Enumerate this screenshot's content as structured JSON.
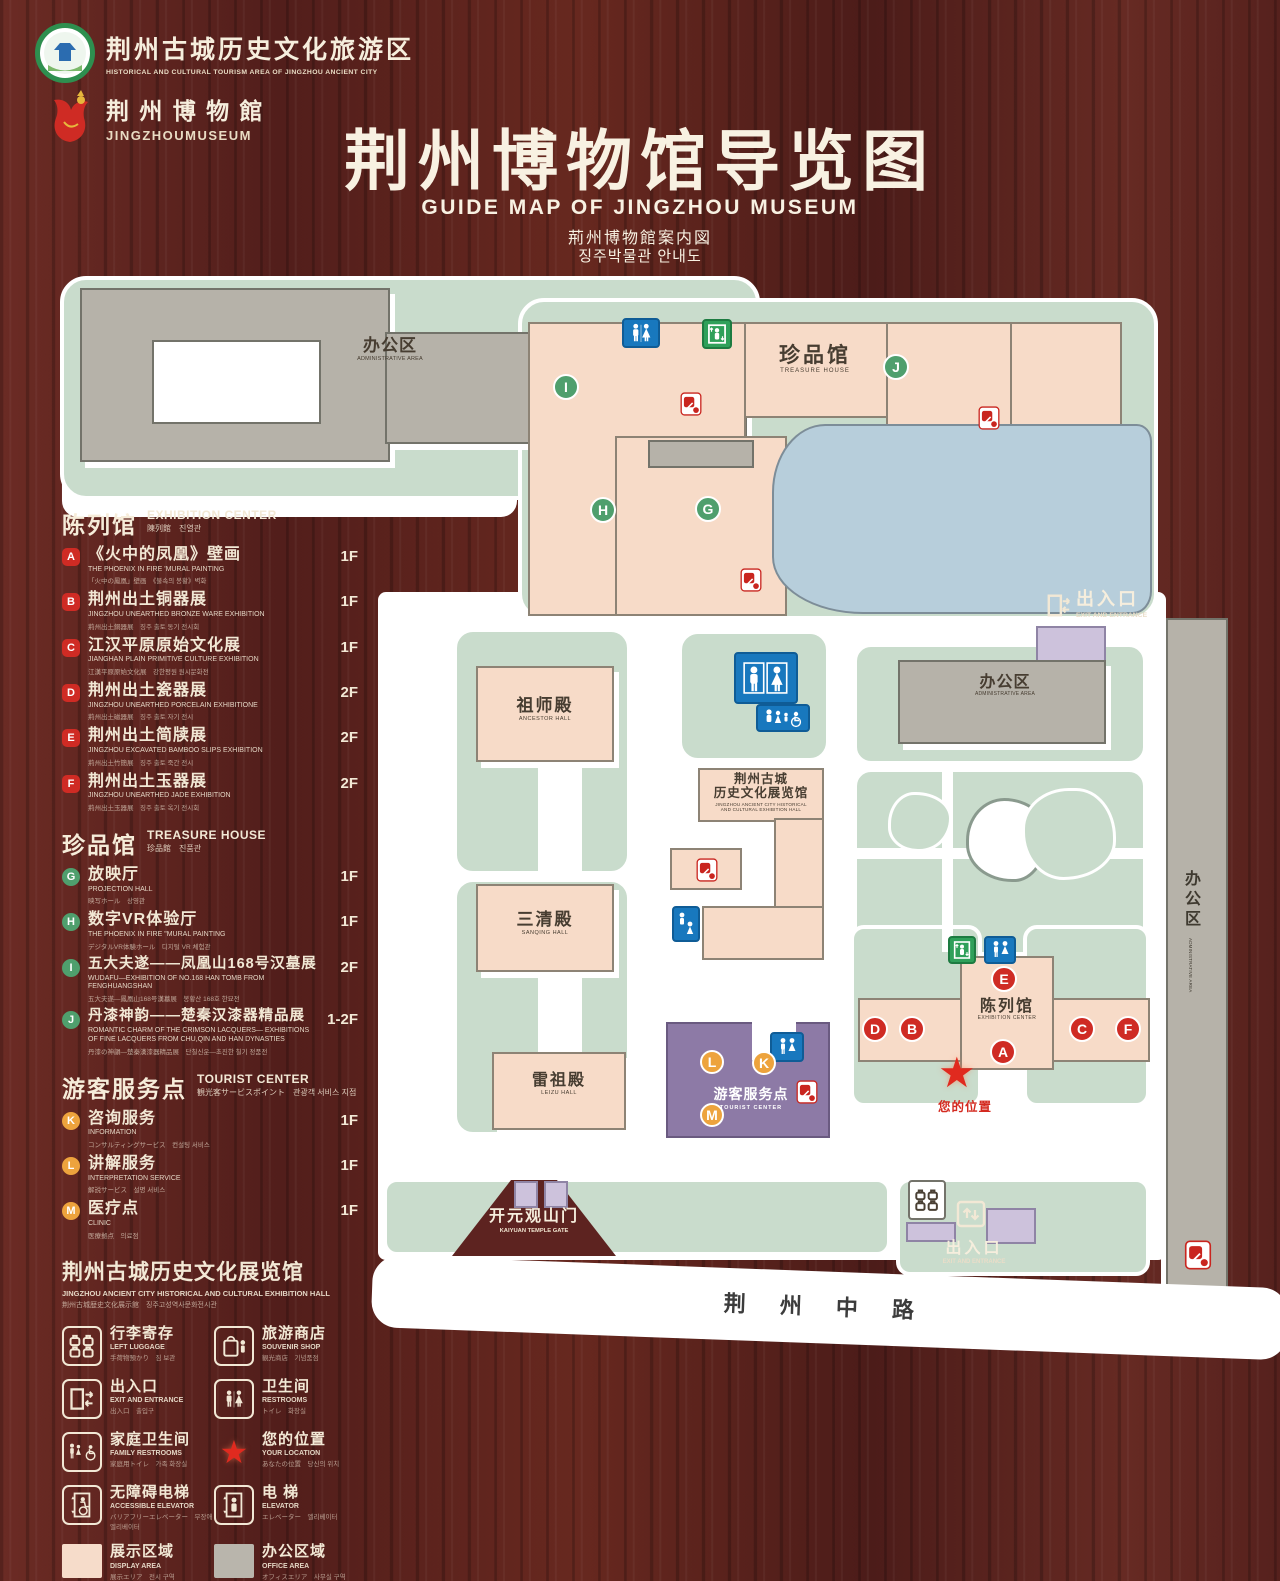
{
  "header": {
    "tourism_area": {
      "name_cn": "荆州古城历史文化旅游区",
      "name_en": "HISTORICAL AND CULTURAL TOURISM AREA OF JINGZHOU ANCIENT CITY"
    },
    "museum": {
      "name_cn": "荆 州 博 物 館",
      "name_en": "JINGZHOUMUSEUM"
    },
    "title": {
      "cn": "荆州博物馆导览图",
      "en": "GUIDE MAP OF JINGZHOU MUSEUM",
      "ja": "荊州博物館案内図",
      "ko": "징주박물관 안내도"
    }
  },
  "legend": {
    "sections": [
      {
        "title_cn": "陈列馆",
        "title_en": "EXHIBITION CENTER",
        "title_sub": "陳列館　진열관",
        "items": [
          {
            "letter": "A",
            "cn": "《火中的凤凰》壁画",
            "en": "THE PHOENIX IN FIRE 'MURAL PAINTING",
            "sub": "「火中の鳳凰」壁画　《불속의 봉황》벽화",
            "floor": "1F"
          },
          {
            "letter": "B",
            "cn": "荆州出土铜器展",
            "en": "JINGZHOU UNEARTHED BRONZE WARE EXHIBITION",
            "sub": "荊州出土銅器展　징주 출토 동기 전시회",
            "floor": "1F"
          },
          {
            "letter": "C",
            "cn": "江汉平原原始文化展",
            "en": "JIANGHAN PLAIN PRIMITIVE CULTURE EXHIBITION",
            "sub": "江漢平原原始文化展　강한평원 원시문화전",
            "floor": "1F"
          },
          {
            "letter": "D",
            "cn": "荆州出土瓷器展",
            "en": "JINGZHOU UNEARTHED PORCELAIN EXHIBITIONE",
            "sub": "荊州出土磁器展　징주 출토 자기 전시",
            "floor": "2F"
          },
          {
            "letter": "E",
            "cn": "荆州出土简牍展",
            "en": "JINGZHOU EXCAVATED BAMBOO SLIPS EXHIBITION",
            "sub": "荊州出土竹簡展　징주 출토 죽간 전시",
            "floor": "2F"
          },
          {
            "letter": "F",
            "cn": "荆州出土玉器展",
            "en": "JINGZHOU UNEARTHED JADE EXHIBITION",
            "sub": "荊州出土玉器展　징주 출토 옥기 전시회",
            "floor": "2F"
          }
        ]
      },
      {
        "title_cn": "珍品馆",
        "title_en": "TREASURE HOUSE",
        "title_sub": "珍品館　진품관",
        "items": [
          {
            "letter": "G",
            "cn": "放映厅",
            "en": "PROJECTION HALL",
            "sub": "映写ホール　상영관",
            "floor": "1F"
          },
          {
            "letter": "H",
            "cn": "数字VR体验厅",
            "en": "THE PHOENIX IN FIRE \"MURAL PAINTING",
            "sub": "デジタルVR体験ホール　디지털 VR 체험관",
            "floor": "1F"
          },
          {
            "letter": "I",
            "cn": "五大夫遂——凤凰山168号汉墓展",
            "en": "WUDAFU—EXHIBITION OF NO.168 HAN TOMB FROM FENGHUANGSHAN",
            "sub": "五大夫遂—鳳凰山168号漢墓展　봉황산 168호 한묘전",
            "floor": "2F"
          },
          {
            "letter": "J",
            "cn": "丹漆神韵——楚秦汉漆器精品展",
            "en": "ROMANTIC CHARM OF THE CRIMSON LACQUERS— EXHIBITIONS OF FINE LACQUERS FROM CHU,QIN AND HAN DYNASTIES",
            "sub": "丹漆の神韻—楚秦漢漆器精品展　단칠신운—초진한 칠기 정품전",
            "floor": "1-2F"
          }
        ]
      },
      {
        "title_cn": "游客服务点",
        "title_en": "TOURIST CENTER",
        "title_sub": "観光客サービスポイント　관광객 서비스 지점",
        "items": [
          {
            "letter": "K",
            "cn": "咨询服务",
            "en": "INFORMATION",
            "sub": "コンサルティングサービス　컨설팅 서비스",
            "floor": "1F"
          },
          {
            "letter": "L",
            "cn": "讲解服务",
            "en": "INTERPRETATION SERVICE",
            "sub": "解説サービス　설명 서비스",
            "floor": "1F"
          },
          {
            "letter": "M",
            "cn": "医疗点",
            "en": "CLINIC",
            "sub": "医療拠点　의료점",
            "floor": "1F"
          }
        ]
      }
    ],
    "hall_note": {
      "cn": "荆州古城历史文化展览馆",
      "en": "JINGZHOU ANCIENT CITY HISTORICAL AND CULTURAL EXHIBITION HALL",
      "sub": "荆州古城歴史文化展示館　징주고성역사문화전시관"
    },
    "symbols": [
      {
        "cn": "行李寄存",
        "en": "LEFT LUGGAGE",
        "sub": "手荷物預かり　짐 보관"
      },
      {
        "cn": "旅游商店",
        "en": "SOUVENIR SHOP",
        "sub": "観光商店　기념품점"
      },
      {
        "cn": "出入口",
        "en": "EXIT AND ENTRANCE",
        "sub": "出入口　출입구"
      },
      {
        "cn": "卫生间",
        "en": "RESTROOMS",
        "sub": "トイレ　화장실"
      },
      {
        "cn": "家庭卫生间",
        "en": "FAMILY RESTROOMS",
        "sub": "家庭用トイレ　가족 화장실"
      },
      {
        "cn": "您的位置",
        "en": "YOUR LOCATION",
        "sub": "あなたの位置　당신의 위치"
      },
      {
        "cn": "无障碍电梯",
        "en": "ACCESSIBLE ELEVATOR",
        "sub": "バリアフリーエレベーター　무장애 엘리베이터"
      },
      {
        "cn": "电 梯",
        "en": "ELEVATOR",
        "sub": "エレベーター　엘리베이터"
      }
    ],
    "areas": [
      {
        "cn": "展示区域",
        "en": "DISPLAY AREA",
        "sub": "展示エリア　전시 구역"
      },
      {
        "cn": "办公区域",
        "en": "OFFICE AREA",
        "sub": "オフィスエリア　사무실 구역"
      }
    ]
  },
  "map": {
    "admin_area": {
      "cn": "办公区",
      "en": "ADMINISTRATIVE AREA"
    },
    "treasure_house": {
      "cn": "珍品馆",
      "en": "TREASURE HOUSE"
    },
    "ancestor_hall": {
      "cn": "祖师殿",
      "en": "ANCESTOR HALL"
    },
    "sanqing_hall": {
      "cn": "三清殿",
      "en": "SANQING HALL"
    },
    "leizu_hall": {
      "cn": "雷祖殿",
      "en": "LEIZU HALL"
    },
    "exhibition_hall": {
      "cn1": "荆州古城",
      "cn2": "历史文化展览馆",
      "en1": "JINGZHOU ANCIENT CITY HISTORICAL",
      "en2": "AND CULTURAL EXHIBITION HALL"
    },
    "tourist_center": {
      "cn": "游客服务点",
      "en": "TOURIST CENTER"
    },
    "exhibition_center": {
      "cn": "陈列馆",
      "en": "EXHIBITION CENTER"
    },
    "gate": {
      "cn": "开元观山门",
      "en": "KAIYUAN TEMPLE GATE"
    },
    "exit_top": {
      "cn": "出入口",
      "en": "EXIT AND ENTRANCE"
    },
    "exit_bottom": {
      "cn": "出入口",
      "en": "EXIT AND ENTRANCE"
    },
    "road": "荆 州 中 路",
    "your_location": "您的位置",
    "markers_green": [
      {
        "letter": "I"
      },
      {
        "letter": "H"
      },
      {
        "letter": "G"
      },
      {
        "letter": "J"
      }
    ],
    "markers_red": [
      {
        "letter": "D"
      },
      {
        "letter": "B"
      },
      {
        "letter": "E"
      },
      {
        "letter": "A"
      },
      {
        "letter": "C"
      },
      {
        "letter": "F"
      }
    ],
    "markers_orange": [
      {
        "letter": "L"
      },
      {
        "letter": "K"
      },
      {
        "letter": "M"
      }
    ]
  },
  "colors": {
    "wood": "#5d2320",
    "plot_green": "#c9dccc",
    "building_pink": "#f7dbc8",
    "building_gray": "#b6b2a9",
    "pond_blue": "#b7cedb",
    "tourist_purple": "#8d7aa6",
    "gate_lavender": "#cdc2dc",
    "icon_blue": "#1878be",
    "icon_green": "#2fa05a",
    "icon_red": "#c9251f",
    "badge_red": "#cf2b24",
    "badge_green": "#4f9f6d",
    "badge_orange": "#eda33d",
    "cream": "#f2e8d5"
  }
}
